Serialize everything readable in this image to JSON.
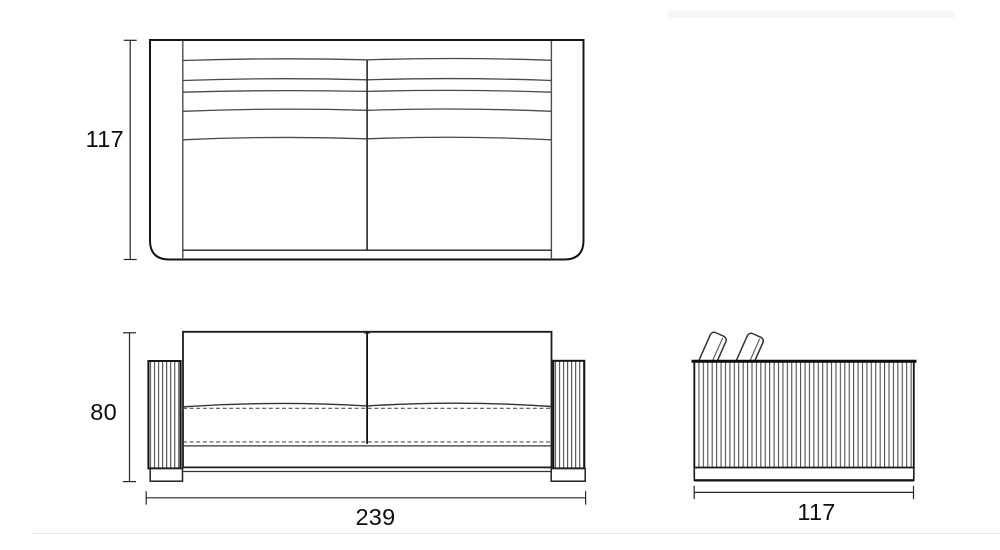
{
  "drawing": {
    "background": "#ffffff",
    "line_color": "#1a1a1a",
    "secondary_line_color": "#555555",
    "dimension_color": "#262626",
    "views": {
      "top": {
        "dimension_depth": "117"
      },
      "front": {
        "dimension_height": "80",
        "dimension_width": "239"
      },
      "side": {
        "dimension_width": "117"
      }
    }
  }
}
